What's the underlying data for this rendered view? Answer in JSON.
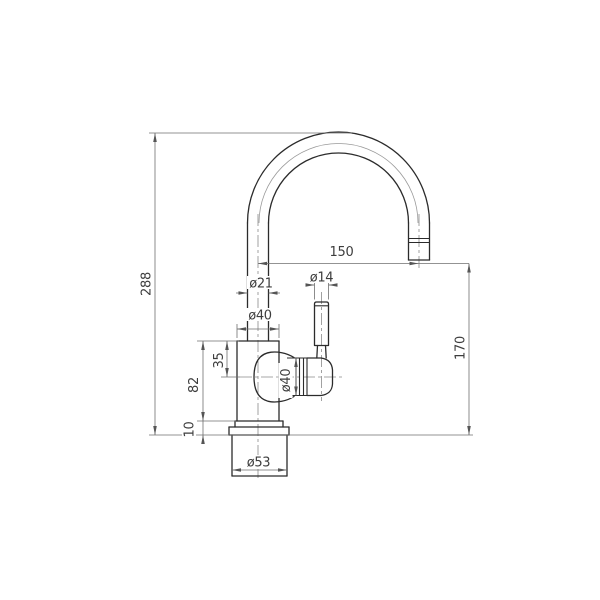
{
  "drawing": {
    "title": "single-lever faucet side-view dimensioned drawing",
    "colors": {
      "background": "#ffffff",
      "object_line": "#2b2b2b",
      "thin_line": "#6f6f6f",
      "center_line": "#8a8a8a",
      "text": "#3d3d3d"
    }
  },
  "dims": {
    "overall_height": "288",
    "spout_reach": "150",
    "outlet_height": "170",
    "spout_tube_diameter": "ø21",
    "riser_base_diameter": "ø40",
    "handle_diameter": "ø14",
    "valve_offset": "35",
    "body_height": "82",
    "flange_height": "10",
    "base_diameter": "ø53",
    "valve_diameter": "ø40"
  },
  "dimensions_mm": {
    "overall_height": 288,
    "spout_reach": 150,
    "outlet_height": 170,
    "spout_tube_diameter": 21,
    "riser_base_diameter": 40,
    "handle_diameter": 14,
    "valve_axis_offset_from_body_top": 35,
    "body_height": 82,
    "flange_height": 10,
    "base_diameter": 53,
    "valve_cartridge_diameter": 40
  }
}
